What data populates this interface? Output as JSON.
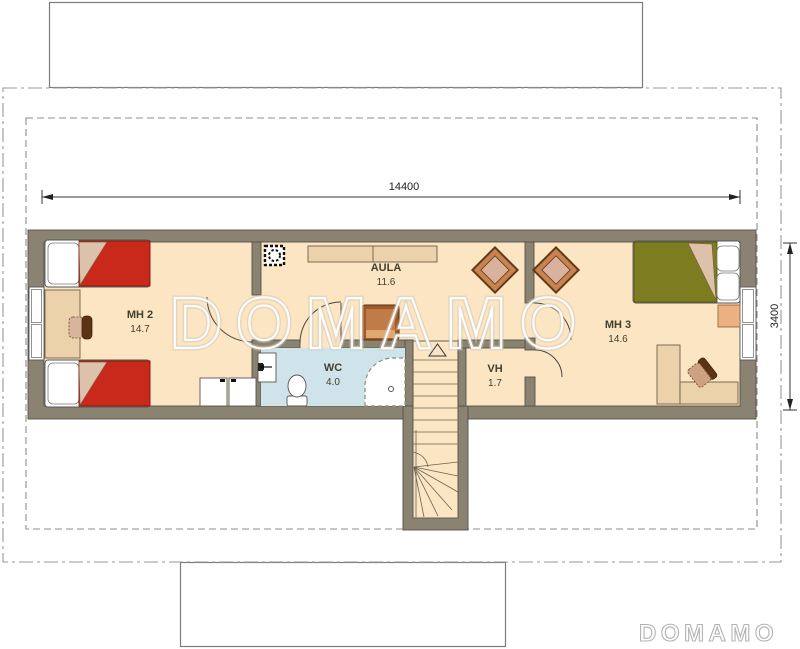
{
  "meta": {
    "type": "floor-plan",
    "level": "attic"
  },
  "watermark": {
    "center_text": "DOMAMO",
    "logo_text": "DOMAMO"
  },
  "dimensions": {
    "horizontal": "14400",
    "vertical": "3400"
  },
  "rooms": [
    {
      "name": "MH 2",
      "area": "14.7"
    },
    {
      "name": "AULA",
      "area": "11.6"
    },
    {
      "name": "WC",
      "area": "4.0"
    },
    {
      "name": "VH",
      "area": "1.7"
    },
    {
      "name": "MH 3",
      "area": "14.6"
    }
  ],
  "icons": {
    "chimney_icon": "hatched square with ring",
    "stairs_up_icon": "triangle arrow",
    "shower_icon": "dashed quarter-round corner tray",
    "door_icon": "quarter-circle swing arc"
  },
  "colors": {
    "wall": "#8b8372",
    "outline": "#55514a",
    "floor": "#fbe5c3",
    "wc_floor": "#cfe4ea",
    "bed_red": "#c8291a",
    "bed_green": "#7c7d20",
    "wood": "#c98350",
    "wood_dark": "#5f3a16",
    "wood_light": "#ecd2ab",
    "cushion": "#d9b29e"
  }
}
